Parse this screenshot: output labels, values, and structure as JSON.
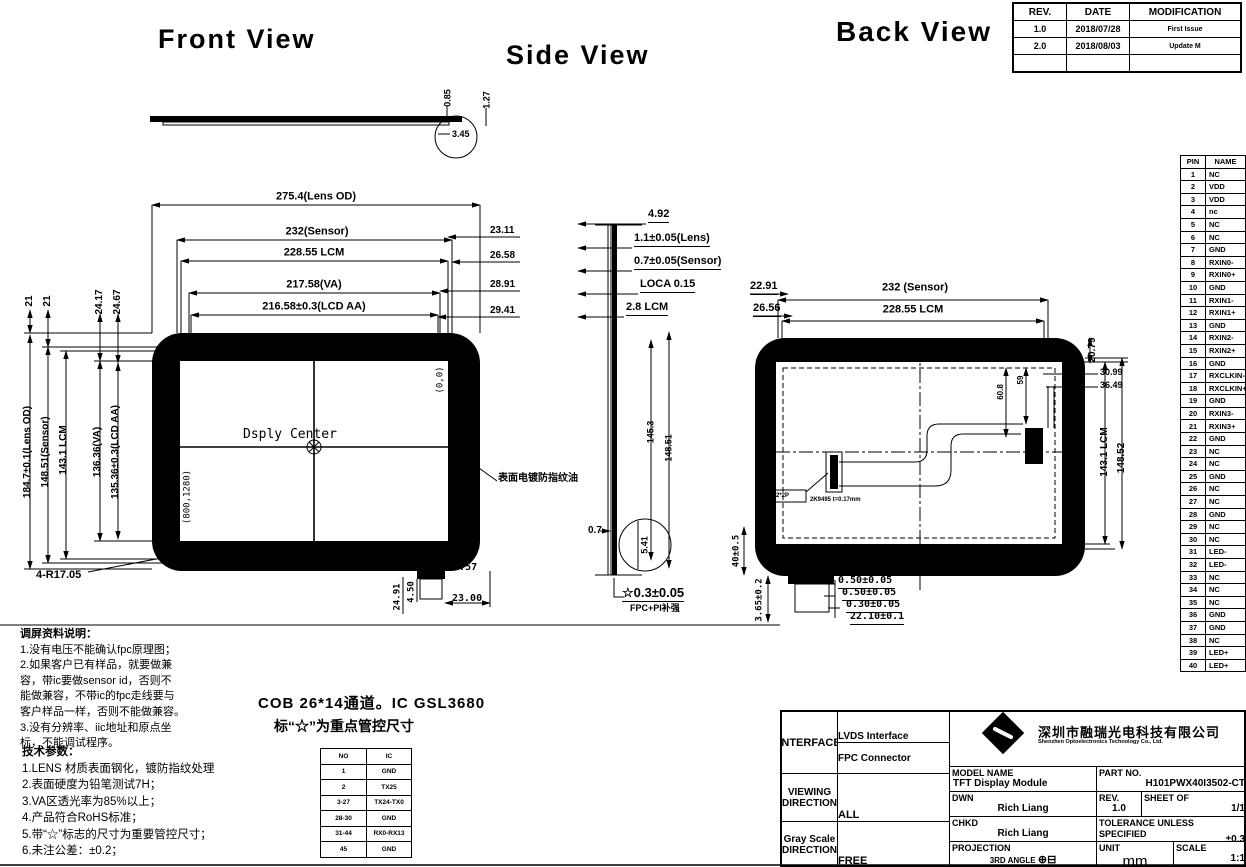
{
  "views": {
    "front": "Front  View",
    "side": "Side View",
    "back": "Back  View"
  },
  "revision_table": {
    "headers": [
      "REV.",
      "DATE",
      "MODIFICATION"
    ],
    "rows": [
      [
        "1.0",
        "2018/07/28",
        "First Issue"
      ],
      [
        "2.0",
        "2018/08/03",
        "Update M"
      ],
      [
        "",
        "",
        ""
      ]
    ]
  },
  "pin_table": {
    "headers": [
      "PIN",
      "NAME"
    ],
    "rows": [
      [
        "1",
        "NC"
      ],
      [
        "2",
        "VDD"
      ],
      [
        "3",
        "VDD"
      ],
      [
        "4",
        "nc"
      ],
      [
        "5",
        "NC"
      ],
      [
        "6",
        "NC"
      ],
      [
        "7",
        "GND"
      ],
      [
        "8",
        "RXIN0-"
      ],
      [
        "9",
        "RXIN0+"
      ],
      [
        "10",
        "GND"
      ],
      [
        "11",
        "RXIN1-"
      ],
      [
        "12",
        "RXIN1+"
      ],
      [
        "13",
        "GND"
      ],
      [
        "14",
        "RXIN2-"
      ],
      [
        "15",
        "RXIN2+"
      ],
      [
        "16",
        "GND"
      ],
      [
        "17",
        "RXCLKIN-"
      ],
      [
        "18",
        "RXCLKIN+"
      ],
      [
        "19",
        "GND"
      ],
      [
        "20",
        "RXIN3-"
      ],
      [
        "21",
        "RXIN3+"
      ],
      [
        "22",
        "GND"
      ],
      [
        "23",
        "NC"
      ],
      [
        "24",
        "NC"
      ],
      [
        "25",
        "GND"
      ],
      [
        "26",
        "NC"
      ],
      [
        "27",
        "NC"
      ],
      [
        "28",
        "GND"
      ],
      [
        "29",
        "NC"
      ],
      [
        "30",
        "NC"
      ],
      [
        "31",
        "LED-"
      ],
      [
        "32",
        "LED-"
      ],
      [
        "33",
        "NC"
      ],
      [
        "34",
        "NC"
      ],
      [
        "35",
        "NC"
      ],
      [
        "36",
        "GND"
      ],
      [
        "37",
        "GND"
      ],
      [
        "38",
        "NC"
      ],
      [
        "39",
        "LED+"
      ],
      [
        "40",
        "LED+"
      ]
    ]
  },
  "profile": {
    "dims": [
      "0.85",
      "1.27",
      "3.45"
    ]
  },
  "front": {
    "top_dims": [
      "275.4(Lens OD)",
      "232(Sensor)",
      "228.55  LCM",
      "217.58(VA)",
      "216.58±0.3(LCD AA)"
    ],
    "right_dims": [
      "23.11",
      "26.58",
      "28.91",
      "29.41"
    ],
    "left_top_dims": [
      "21",
      "21",
      "24.17",
      "24.67"
    ],
    "left_dims": [
      "184.7±0.1(Lens OD)",
      "148.51(Sensor)",
      "143.1 LCM",
      "136.36(VA)",
      "135.36±0.3(LCD AA)"
    ],
    "center_label": "Dsply Center",
    "coord_origin": "(0,0)",
    "coord_end": "(800,1280)",
    "corner_radius": "4-R17.05",
    "silkscreen": "黑色丝印",
    "bottom_dims": [
      "28.57",
      "23.00"
    ],
    "bottom_rot_dims": [
      "24.91",
      "4.50"
    ],
    "coating_note": "表面电镀防指纹油"
  },
  "side": {
    "stack_dims": [
      "4.92",
      "1.1±0.05(Lens)",
      "0.7±0.05(Sensor)",
      "LOCA 0.15",
      "2.8 LCM"
    ],
    "height_dims": [
      "145.3",
      "148.51"
    ],
    "bottom_dims": [
      "0.7",
      "5.41"
    ],
    "fpc_dim": "☆0.3±0.05",
    "fpc_note": "FPC+PI补强"
  },
  "back": {
    "left_top_dims": [
      "22.91",
      "26.56"
    ],
    "top_dims": [
      "232 (Sensor)",
      "228.55 LCM"
    ],
    "right_rot_dim": "20.79",
    "right_leader_dims": [
      "30.99",
      "36.49"
    ],
    "inner_rot_dims": [
      "60.8",
      "59"
    ],
    "right_side_dims": [
      "143.1 LCM",
      "148.52"
    ],
    "left_rot_dims": [
      "40±0.5",
      "3.65±0.2"
    ],
    "bottom_stack_dims": [
      "0.50±0.05",
      "0.50±0.05",
      "0.30±0.05",
      "22.10±0.1"
    ],
    "fpc_labels": [
      "2*2P",
      "2K9495 t=0.17mm"
    ]
  },
  "notes": {
    "heading": "调屏资料说明：",
    "lines": [
      "1.没有电压不能确认fpc原理图；",
      "2.如果客户已有样品，就要做兼",
      "容，带ic要做sensor id，否则不",
      "能做兼容，不带ic的fpc走线要与",
      "客户样品一样，否则不能做兼容。",
      "3.没有分辨率、iic地址和原点坐",
      "标，不能调试程序。"
    ]
  },
  "tech": {
    "heading": "技术参数：",
    "lines": [
      "1.LENS 材质表面钢化，镀防指纹处理",
      "2.表面硬度为铅笔测试7H；",
      "3.VA区透光率为85%以上；",
      "4.产品符合RoHS标准；",
      "5.带“☆”标志的尺寸为重要管控尺寸；",
      "6.未注公差：±0.2；"
    ]
  },
  "cob": {
    "line1": "COB  26*14通道。IC  GSL3680",
    "line2": "标“☆”为重点管控尺寸"
  },
  "connector_table": {
    "headers": [
      "NO",
      "IC"
    ],
    "rows": [
      [
        "1",
        "GND"
      ],
      [
        "2",
        "TX25"
      ],
      [
        "3-27",
        "TX24-TX0"
      ],
      [
        "28-30",
        "GND"
      ],
      [
        "31-44",
        "RX0-RX13"
      ],
      [
        "45",
        "GND"
      ]
    ]
  },
  "title_block": {
    "interface_label": "INTERFACE",
    "interface_value1": "LVDS Interface",
    "interface_value2": "FPC Connector",
    "viewing_label1": "VIEWING",
    "viewing_label2": "DIRECTION",
    "viewing_value": "ALL",
    "gray_label1": "Gray Scale",
    "gray_label2": "DIRECTION",
    "gray_value": "FREE",
    "company_cn": "深圳市融瑞光电科技有限公司",
    "company_en": "Shenzhen Optoelectronics Technology Co., Ltd.",
    "model_label": "MODEL NAME",
    "model_value": "TFT Display Module",
    "part_label": "PART NO.",
    "part_value": "H101PWX40I3502-CT",
    "dwn_label": "DWN",
    "dwn_value": "Rich Liang",
    "rev_label": "REV.",
    "rev_value": "1.0",
    "sheet_label": "SHEET OF",
    "sheet_value": "1/1",
    "chkd_label": "CHKD",
    "chkd_value": "Rich Liang",
    "tol_label1": "TOLERANCE UNLESS",
    "tol_label2": "SPECIFIED",
    "tol_value": "±0.3",
    "proj_label": "PROJECTION",
    "proj_value": "3RD ANGLE",
    "projection_symbol": "⊕⊟",
    "unit_label": "UNIT",
    "unit_value": "mm",
    "scale_label": "SCALE",
    "scale_value": "1:1"
  }
}
